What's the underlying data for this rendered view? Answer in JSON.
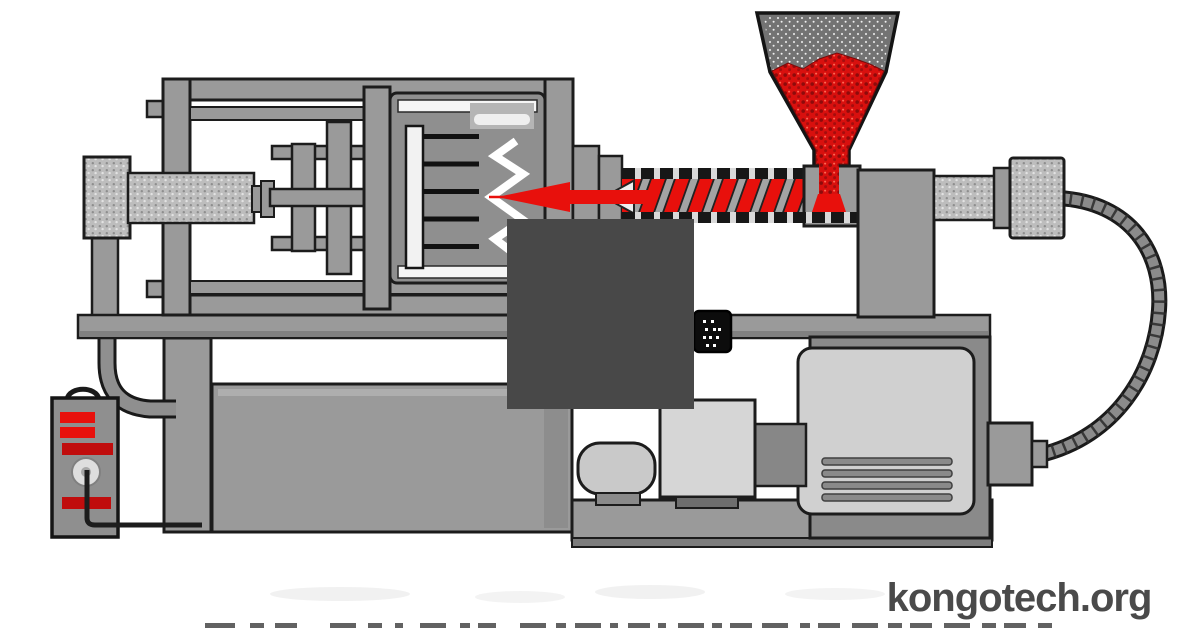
{
  "watermark": {
    "text": "kongotech.org",
    "color": "#4a4a4a"
  },
  "colors": {
    "background": "#ffffff",
    "machine_gray": "#9a9a9a",
    "machine_gray_light": "#d0d0d0",
    "machine_gray_dark": "#7d7d7d",
    "outline": "#1c1c1c",
    "accent_red": "#e8100c",
    "dark_red": "#c00d0d",
    "pellet_red": "#d8100e",
    "overlay_gray": "#484848"
  }
}
